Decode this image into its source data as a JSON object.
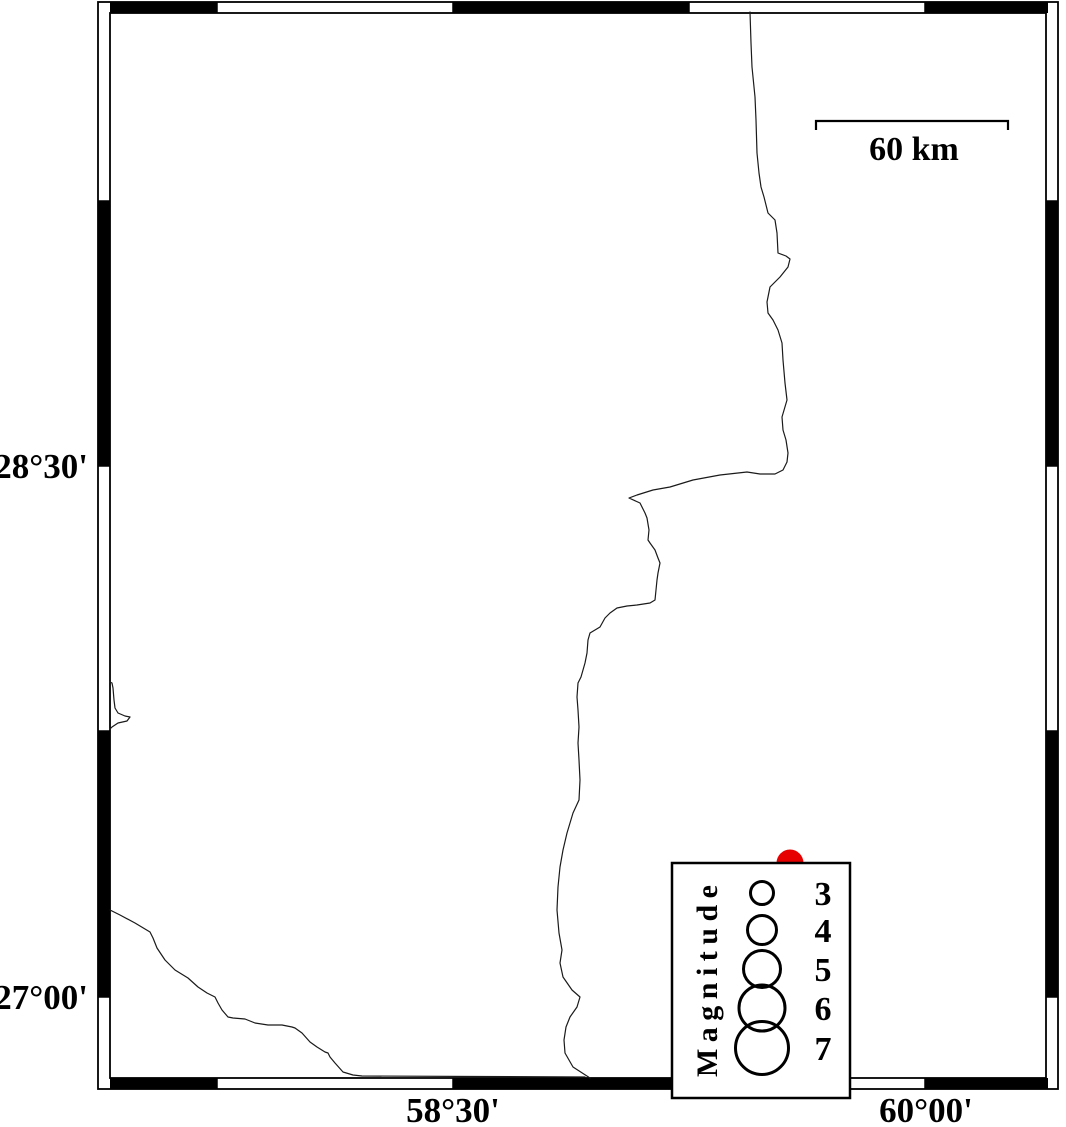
{
  "map": {
    "background_color": "#ffffff",
    "frame_color": "#000000",
    "lat_ticks": [
      {
        "label": "28°30'"
      },
      {
        "label": "27°00'"
      }
    ],
    "lon_ticks": [
      {
        "label": "58°30'"
      },
      {
        "label": "60°00'"
      }
    ]
  },
  "scalebar": {
    "label": "60 km"
  },
  "legend": {
    "title": "Magnitude",
    "circle_cx": 762,
    "items": [
      {
        "label": "3",
        "magnitude": 3,
        "cy": 893,
        "r": 11.5,
        "label_y": 905
      },
      {
        "label": "4",
        "magnitude": 4,
        "cy": 930,
        "r": 14.5,
        "label_y": 942
      },
      {
        "label": "5",
        "magnitude": 5,
        "cy": 969,
        "r": 18.5,
        "label_y": 981
      },
      {
        "label": "6",
        "magnitude": 6,
        "cy": 1008,
        "r": 23,
        "label_y": 1020
      },
      {
        "label": "7",
        "magnitude": 7,
        "cy": 1048,
        "r": 26.5,
        "label_y": 1060
      }
    ]
  },
  "epicenters": [
    {
      "cx": 790,
      "cy": 863,
      "r": 13.5,
      "color": "#e60000"
    }
  ],
  "coastlines": {
    "main": "M750,12 L751,43 L752,67 L755,97 L756,120 L757,153 L759,173 L761,187 L764,197 L768,213 L775,220 L777,233 L778,253 L786,256 L790,259 L788,267 L780,277 L770,287 L767,302 L768,313 L773,320 L778,330 L782,343 L783,360 L785,383 L787,400 L782,417 L783,430 L786,440 L788,453 L787,462 L783,470 L775,474 L760,474 L747,472 L720,475 L693,480 L670,487 L653,490 L637,495 L629,498 L640,503 L645,513 L647,518 L649,530 L648,540 L650,543 L655,550 L658,558 L660,563 L658,573 L657,580 L656,590 L655,600 L650,603 L637,605 L627,606 L617,608 L610,613 L605,618 L600,627 L590,633 L588,640 L587,653 L585,663 L581,677 L578,683 L577,697 L578,710 L579,727 L578,743 L579,760 L580,780 L579,800 L573,813 L567,833 L563,850 L560,867 L558,887 L557,910 L559,933 L562,950 L560,963 L563,977 L572,990 L580,997 L577,1007 L570,1017 L566,1027 L564,1040 L565,1053 L573,1067 L590,1078",
    "southwest": "M110,910 L120,915 L135,923 L150,932 L153,938 L157,948 L165,960 L175,970 L188,978 L198,987 L207,993 L215,997 L218,1003 L222,1010 L228,1017 L233,1018 L245,1019 L255,1023 L268,1025 L282,1025 L292,1027 L295,1028 L302,1033 L310,1042 L317,1047 L325,1052 L328,1053 L330,1057 L335,1063 L343,1072 L353,1075 L362,1076 L585,1077",
    "west_cape": "M110,682 L112,683 L113,688 L114,700 L115,708 L118,713 L125,716 L130,717 L127,721 L118,723 L112,727 L110,729"
  }
}
